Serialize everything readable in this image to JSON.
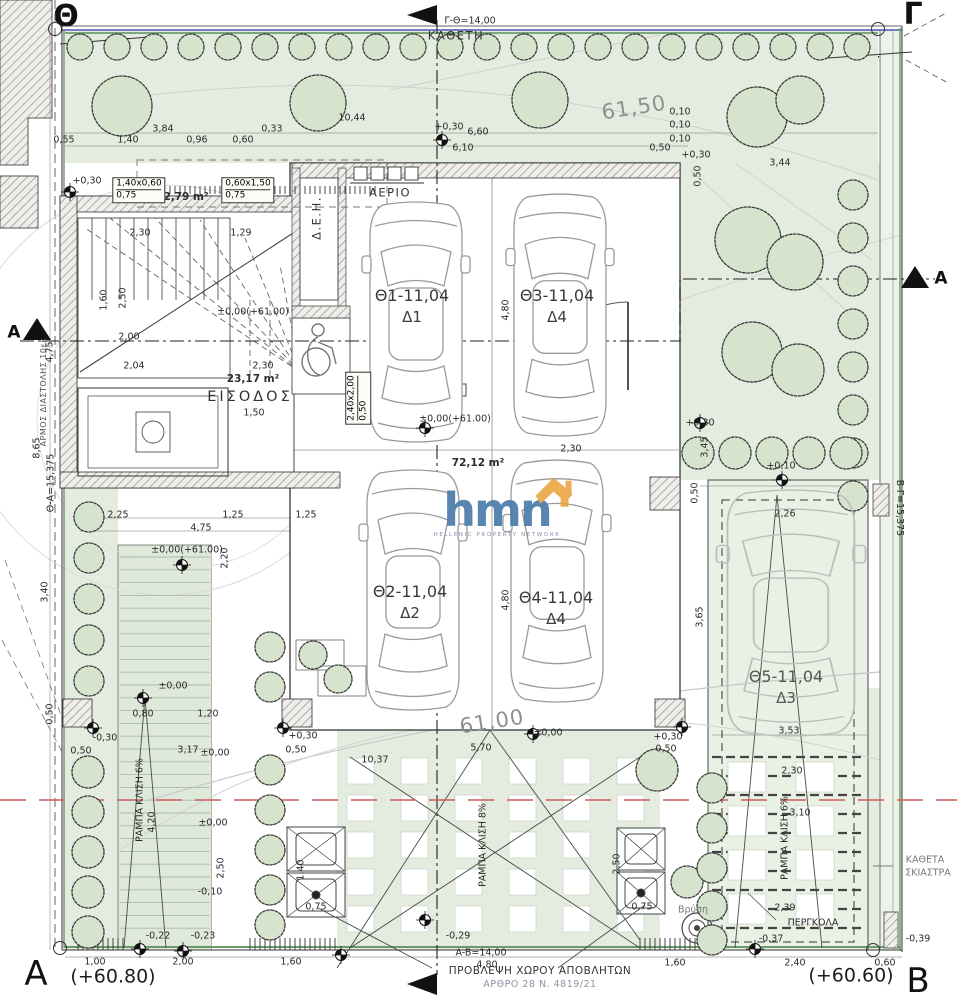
{
  "site": {
    "corners": {
      "theta": {
        "letter": "Θ",
        "elev": "(+61.39)"
      },
      "gamma": {
        "letter": "Γ",
        "elev": "(+61.45)"
      },
      "alpha": {
        "letter": "A",
        "elev": "(+60.80)"
      },
      "beta": {
        "letter": "B",
        "elev": "(+60.60)"
      }
    }
  },
  "logo": {
    "text": "hmn",
    "tagline": "HELLENIC PROPERTY NETWORK"
  },
  "waste_note": {
    "line1": "ΠΡΟΒΛΕΨΗ ΧΩΡΟΥ ΑΠΟΒΛΗΤΩΝ",
    "line2": "ΑΡΘΡΟ 28 Ν. 4819/21"
  },
  "parking": [
    {
      "name": "parking-space-1",
      "id": "Θ1-11,04",
      "unit": "Δ1",
      "x": 412,
      "y": 306
    },
    {
      "name": "parking-space-3",
      "id": "Θ3-11,04",
      "unit": "Δ4",
      "x": 557,
      "y": 306
    },
    {
      "name": "parking-space-2",
      "id": "Θ2-11,04",
      "unit": "Δ2",
      "x": 410,
      "y": 602
    },
    {
      "name": "parking-space-4",
      "id": "Θ4-11,04",
      "unit": "Δ4",
      "x": 556,
      "y": 608
    },
    {
      "name": "parking-space-5",
      "id": "Θ5-11,04",
      "unit": "Δ3",
      "x": 786,
      "y": 687
    }
  ],
  "boxes": [
    {
      "t1": "1,40x0,60",
      "t2": "0,75",
      "x": 139,
      "y": 190,
      "r": 0
    },
    {
      "t1": "0,60x1,50",
      "t2": "0,75",
      "x": 248,
      "y": 190,
      "r": 0
    },
    {
      "t1": "2,40x2,00",
      "t2": "0,50",
      "x": 358,
      "y": 398,
      "r": -90
    }
  ],
  "labels": [
    {
      "n": "boundary-length-top",
      "t": "Γ-Θ=14,00",
      "x": 470,
      "y": 21
    },
    {
      "n": "boundary-name-kathet",
      "t": "ΚΑΘΕΤΗ",
      "x": 456,
      "y": 36,
      "c": "r12"
    },
    {
      "n": "dim",
      "t": "10,44",
      "x": 352,
      "y": 118
    },
    {
      "n": "dim",
      "t": "3,84",
      "x": 163,
      "y": 129
    },
    {
      "n": "dim",
      "t": "0,55",
      "x": 64,
      "y": 140
    },
    {
      "n": "dim",
      "t": "1,40",
      "x": 128,
      "y": 140
    },
    {
      "n": "dim",
      "t": "0,96",
      "x": 197,
      "y": 140
    },
    {
      "n": "dim",
      "t": "0,60",
      "x": 243,
      "y": 140
    },
    {
      "n": "dim",
      "t": "0,33",
      "x": 272,
      "y": 129
    },
    {
      "n": "level",
      "t": "+0,30",
      "x": 87,
      "y": 181
    },
    {
      "n": "area-planter",
      "t": "2,79 m²",
      "x": 186,
      "y": 197,
      "c": "area"
    },
    {
      "n": "level",
      "t": "+0,30",
      "x": 449,
      "y": 127
    },
    {
      "n": "dim",
      "t": "6,60",
      "x": 478,
      "y": 132
    },
    {
      "n": "dim",
      "t": "6,10",
      "x": 463,
      "y": 148
    },
    {
      "n": "dim",
      "t": "0,10",
      "x": 680,
      "y": 112
    },
    {
      "n": "dim",
      "t": "0,10",
      "x": 680,
      "y": 125
    },
    {
      "n": "dim",
      "t": "0,10",
      "x": 680,
      "y": 139
    },
    {
      "n": "dim",
      "t": "0,50",
      "x": 660,
      "y": 148
    },
    {
      "n": "level",
      "t": "+0,30",
      "x": 696,
      "y": 155
    },
    {
      "n": "dim",
      "t": "3,44",
      "x": 780,
      "y": 163
    },
    {
      "n": "dim",
      "t": "0,50",
      "x": 698,
      "y": 176,
      "r": -90
    },
    {
      "n": "contour-label",
      "t": "61,50",
      "x": 634,
      "y": 108,
      "r": -9,
      "c": "contour"
    },
    {
      "n": "contour-label",
      "t": "61,00",
      "x": 492,
      "y": 722,
      "r": -9,
      "c": "contour"
    },
    {
      "n": "label-gas",
      "t": "ΑΕΡΙΟ",
      "x": 390,
      "y": 193,
      "c": "r12"
    },
    {
      "n": "label-deh",
      "t": "Δ.Ε.Η.",
      "x": 317,
      "y": 218,
      "r": -90,
      "c": "r12"
    },
    {
      "n": "dim",
      "t": "2,30",
      "x": 140,
      "y": 233
    },
    {
      "n": "dim",
      "t": "1,29",
      "x": 241,
      "y": 233
    },
    {
      "n": "dim",
      "t": "2,50",
      "x": 123,
      "y": 298,
      "r": -90
    },
    {
      "n": "level",
      "t": "±0,00(+61.00)",
      "x": 253,
      "y": 312
    },
    {
      "n": "dim",
      "t": "2,04",
      "x": 134,
      "y": 366
    },
    {
      "n": "dim",
      "t": "1,60",
      "x": 104,
      "y": 300,
      "r": -90
    },
    {
      "n": "dim",
      "t": "2,00",
      "x": 129,
      "y": 337
    },
    {
      "n": "dim",
      "t": "2,30",
      "x": 263,
      "y": 366
    },
    {
      "n": "area-entrance",
      "t": "23,17 m²",
      "x": 253,
      "y": 379,
      "c": "area"
    },
    {
      "n": "room-entrance",
      "t": "ΕΙΣΟΔΟΣ",
      "x": 250,
      "y": 397,
      "c": "room"
    },
    {
      "n": "dim",
      "t": "1,50",
      "x": 254,
      "y": 413
    },
    {
      "n": "dim",
      "t": "4,80",
      "x": 506,
      "y": 310,
      "r": -90
    },
    {
      "n": "level",
      "t": "±0,00(+61.00)",
      "x": 455,
      "y": 419
    },
    {
      "n": "dim",
      "t": "2,30",
      "x": 571,
      "y": 449
    },
    {
      "n": "area-garage",
      "t": "72,12 m²",
      "x": 478,
      "y": 463,
      "c": "area"
    },
    {
      "n": "dim",
      "t": "2,25",
      "x": 118,
      "y": 515
    },
    {
      "n": "dim",
      "t": "1,25",
      "x": 233,
      "y": 515
    },
    {
      "n": "dim",
      "t": "1,25",
      "x": 306,
      "y": 515
    },
    {
      "n": "dim",
      "t": "4,75",
      "x": 201,
      "y": 528
    },
    {
      "n": "level",
      "t": "±0,00(+61.00)",
      "x": 187,
      "y": 550
    },
    {
      "n": "dim",
      "t": "2,20",
      "x": 225,
      "y": 558,
      "r": -90
    },
    {
      "n": "dim",
      "t": "4,80",
      "x": 506,
      "y": 600,
      "r": -90
    },
    {
      "n": "level",
      "t": "+0,30",
      "x": 700,
      "y": 423
    },
    {
      "n": "dim",
      "t": "3,45",
      "x": 705,
      "y": 447,
      "r": -90
    },
    {
      "n": "level",
      "t": "+0,10",
      "x": 781,
      "y": 466
    },
    {
      "n": "dim",
      "t": "0,50",
      "x": 695,
      "y": 493,
      "r": -90
    },
    {
      "n": "dim",
      "t": "2,26",
      "x": 785,
      "y": 514
    },
    {
      "n": "dim",
      "t": "3,65",
      "x": 700,
      "y": 617,
      "r": -90
    },
    {
      "n": "dim",
      "t": "3,53",
      "x": 789,
      "y": 731
    },
    {
      "n": "dim",
      "t": "2,30",
      "x": 792,
      "y": 771
    },
    {
      "n": "dim",
      "t": "3,10",
      "x": 800,
      "y": 813
    },
    {
      "n": "ramp-right-label",
      "t": "ΡΑΜΠΑ ΚΛΙΣΗ 6%",
      "x": 785,
      "y": 838,
      "r": -90
    },
    {
      "n": "label-shading",
      "t": "ΚΑΘΕΤΑ",
      "x": 925,
      "y": 860,
      "c": "gray"
    },
    {
      "n": "label-shading",
      "t": "ΣΚΙΑΣΤΡΑ",
      "x": 928,
      "y": 873,
      "c": "gray"
    },
    {
      "n": "label-pergola",
      "t": "ΠΕΡΓΚΟΛΑ",
      "x": 813,
      "y": 923
    },
    {
      "n": "dim",
      "t": "2,39",
      "x": 785,
      "y": 908
    },
    {
      "n": "label-faucet",
      "t": "Βρύση",
      "x": 693,
      "y": 910,
      "c": "gray"
    },
    {
      "n": "level",
      "t": "-0,37",
      "x": 771,
      "y": 939
    },
    {
      "n": "level",
      "t": "-0,39",
      "x": 918,
      "y": 939
    },
    {
      "n": "dim",
      "t": "1,60",
      "x": 675,
      "y": 963
    },
    {
      "n": "dim",
      "t": "2,40",
      "x": 795,
      "y": 963
    },
    {
      "n": "dim",
      "t": "0,60",
      "x": 885,
      "y": 963
    },
    {
      "n": "ramp-center-label",
      "t": "ΡΑΜΠΑ ΚΛΙΣΗ 8%",
      "x": 483,
      "y": 845,
      "r": -90
    },
    {
      "n": "ramp-left-label",
      "t": "ΡΑΜΠΑ ΚΛΙΣΗ 6%",
      "x": 140,
      "y": 800,
      "r": -90
    },
    {
      "n": "dim",
      "t": "4,20",
      "x": 152,
      "y": 822,
      "r": -90
    },
    {
      "n": "level",
      "t": "±0,00",
      "x": 173,
      "y": 686
    },
    {
      "n": "dim",
      "t": "0,80",
      "x": 143,
      "y": 714
    },
    {
      "n": "dim",
      "t": "1,20",
      "x": 208,
      "y": 714
    },
    {
      "n": "level",
      "t": "-0,30",
      "x": 105,
      "y": 738
    },
    {
      "n": "dim",
      "t": "0,50",
      "x": 81,
      "y": 751
    },
    {
      "n": "dim",
      "t": "3,17",
      "x": 188,
      "y": 750
    },
    {
      "n": "level",
      "t": "±0,00",
      "x": 215,
      "y": 753
    },
    {
      "n": "level",
      "t": "+0,30",
      "x": 303,
      "y": 736
    },
    {
      "n": "dim",
      "t": "0,50",
      "x": 296,
      "y": 750
    },
    {
      "n": "dim",
      "t": "10,37",
      "x": 375,
      "y": 760
    },
    {
      "n": "dim",
      "t": "5,70",
      "x": 481,
      "y": 748
    },
    {
      "n": "level",
      "t": "±0,00",
      "x": 548,
      "y": 733
    },
    {
      "n": "level",
      "t": "+0,30",
      "x": 668,
      "y": 737
    },
    {
      "n": "dim",
      "t": "0,50",
      "x": 666,
      "y": 749
    },
    {
      "n": "level",
      "t": "±0,00",
      "x": 213,
      "y": 823
    },
    {
      "n": "dim",
      "t": "2,50",
      "x": 221,
      "y": 868,
      "r": -90
    },
    {
      "n": "level",
      "t": "-0,10",
      "x": 210,
      "y": 892
    },
    {
      "n": "level",
      "t": "-0,22",
      "x": 158,
      "y": 936
    },
    {
      "n": "level",
      "t": "-0,23",
      "x": 203,
      "y": 936
    },
    {
      "n": "level",
      "t": "-0,29",
      "x": 458,
      "y": 936
    },
    {
      "n": "dim",
      "t": "1,00",
      "x": 95,
      "y": 962
    },
    {
      "n": "dim",
      "t": "2,00",
      "x": 183,
      "y": 962
    },
    {
      "n": "dim",
      "t": "1,60",
      "x": 291,
      "y": 962
    },
    {
      "n": "dim",
      "t": "0,75",
      "x": 316,
      "y": 907
    },
    {
      "n": "dim",
      "t": "1,40",
      "x": 301,
      "y": 870,
      "r": -90
    },
    {
      "n": "dim",
      "t": "2,50",
      "x": 617,
      "y": 864,
      "r": -90
    },
    {
      "n": "dim",
      "t": "0,75",
      "x": 642,
      "y": 907
    },
    {
      "n": "boundary-length-bottom",
      "t": "A-B=14,00",
      "x": 481,
      "y": 953
    },
    {
      "n": "dim",
      "t": "4,80",
      "x": 487,
      "y": 965
    },
    {
      "n": "boundary-length-left",
      "t": "Θ-Α=15,375",
      "x": 51,
      "y": 483,
      "r": -90
    },
    {
      "n": "boundary-length-right",
      "t": "B-Γ=15,375",
      "x": 899,
      "y": 508,
      "r": 90
    },
    {
      "n": "label-expansion-joint",
      "t": "ΑΡΜΟΣ ΔΙΑΣΤΟΛΗΣ 10εκ",
      "x": 44,
      "y": 392,
      "r": -90,
      "c": "tiny"
    },
    {
      "n": "dim",
      "t": "4,75",
      "x": 50,
      "y": 352,
      "r": -90
    },
    {
      "n": "dim",
      "t": "8,65",
      "x": 37,
      "y": 448,
      "r": -90
    },
    {
      "n": "dim",
      "t": "3,40",
      "x": 45,
      "y": 592,
      "r": -90
    },
    {
      "n": "dim",
      "t": "0,50",
      "x": 50,
      "y": 714,
      "r": -90
    },
    {
      "n": "section-letter-a-left",
      "t": "A",
      "x": 14,
      "y": 333,
      "c": "marker"
    },
    {
      "n": "section-letter-a-right",
      "t": "A",
      "x": 941,
      "y": 279,
      "c": "marker"
    }
  ],
  "colors": {
    "garden": "#e3ecdf",
    "garden_light": "#ecf2e8",
    "tree_fill": "#d6e4cd",
    "boundary_green": "#5a8f5a",
    "boundary_blue": "#7b7bc0",
    "red_axis": "#cc5c5c",
    "logo_blue": "#4d7dab",
    "logo_orange": "#e8a33d"
  }
}
